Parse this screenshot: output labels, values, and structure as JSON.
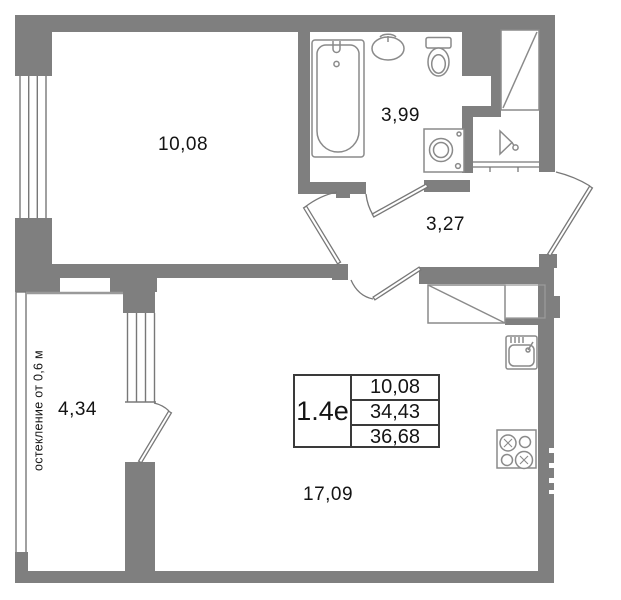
{
  "plan": {
    "rooms": [
      {
        "name": "room",
        "area": "10,08"
      },
      {
        "name": "bathroom",
        "area": "3,99"
      },
      {
        "name": "hallway",
        "area": "3,27"
      },
      {
        "name": "balcony",
        "area": "4,34"
      },
      {
        "name": "living-kitchen",
        "area": "17,09"
      }
    ],
    "balcony_note": "остекление от 0,6 м",
    "info_table": {
      "type": "1.4е",
      "values": [
        "10,08",
        "34,43",
        "36,68"
      ]
    }
  },
  "colors": {
    "wall": "#7f7f7f",
    "thin_line": "#787878",
    "fixture_line": "#8a8a8a",
    "text": "#141414",
    "background": "#ffffff"
  }
}
